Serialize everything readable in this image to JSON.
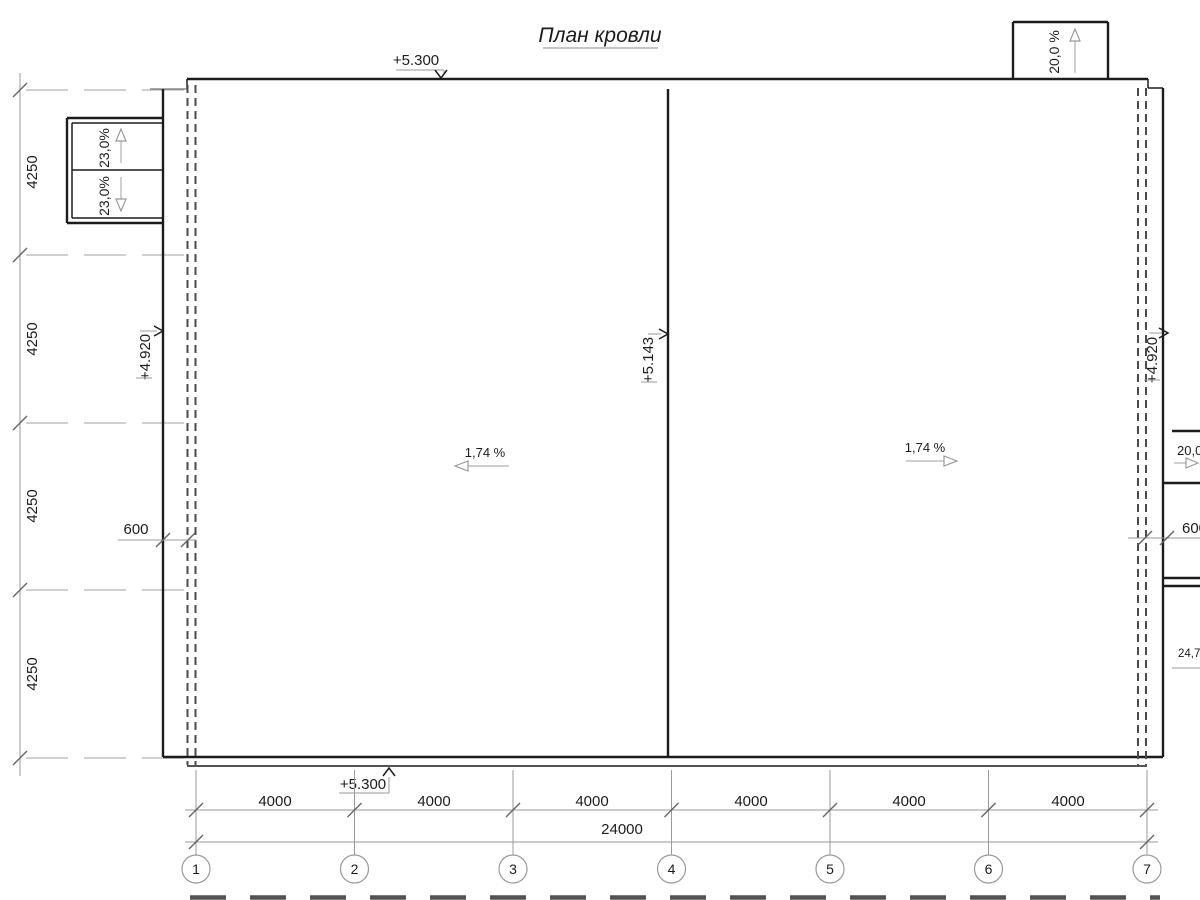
{
  "title": "План кровли",
  "grid": {
    "columns": [
      "1",
      "2",
      "3",
      "4",
      "5",
      "6",
      "7"
    ]
  },
  "dims": {
    "left": [
      "4250",
      "4250",
      "4250",
      "4250"
    ],
    "bottom": [
      "4000",
      "4000",
      "4000",
      "4000",
      "4000",
      "4000"
    ],
    "total": "24000",
    "parapet_left": "600",
    "parapet_right": "600"
  },
  "elev": {
    "top": "+5.300",
    "bottom": "+5.300",
    "left": "+4.920",
    "right": "+4.920",
    "ridge": "+5.143"
  },
  "slopes": {
    "canopy_upper": "23,0%",
    "canopy_lower": "23,0%",
    "dormer_top": "20,0 %",
    "main_left": "1,74 %",
    "main_right": "1,74 %",
    "right_edge": "20,0 %",
    "right_lower": "24,7"
  }
}
